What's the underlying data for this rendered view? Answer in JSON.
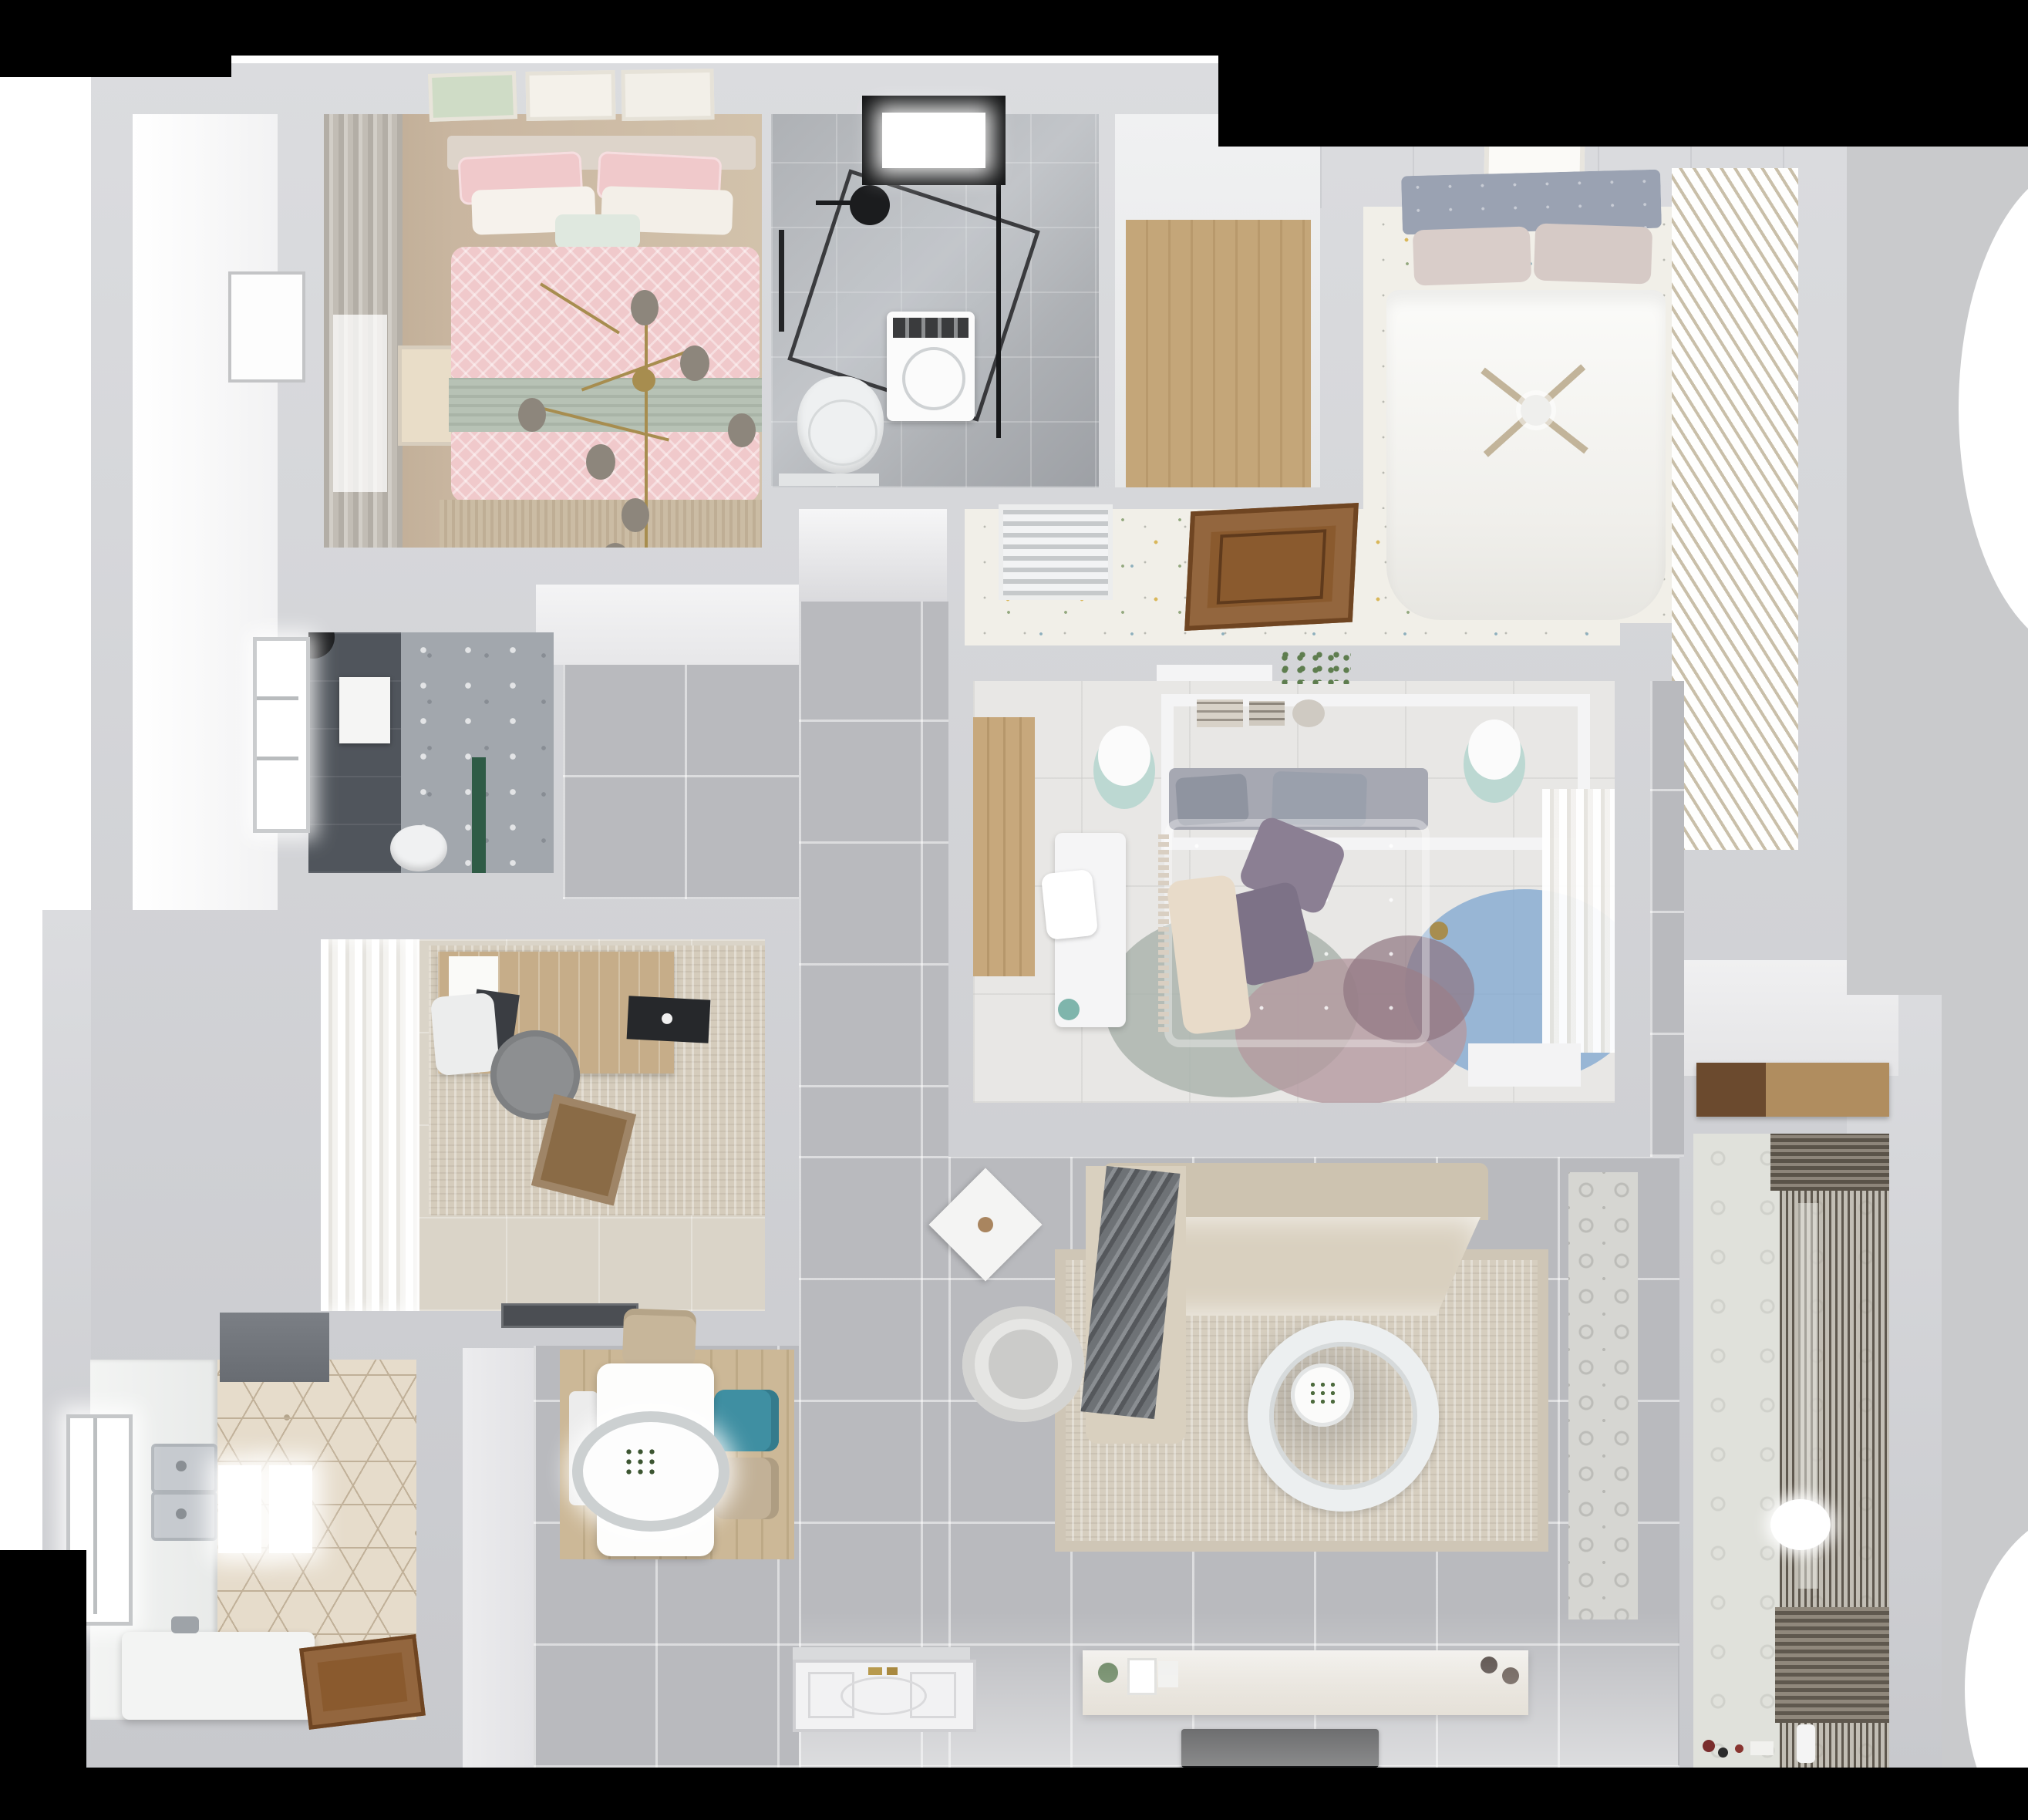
{
  "scene": {
    "type": "3d-floor-plan-render",
    "view": "top-down",
    "description": "Photorealistic bird's-eye render of a three-bedroom apartment interior"
  },
  "colors": {
    "black": "#000000",
    "wall": "#c8c9cd",
    "wallLight": "#dbdcdf",
    "tile": "#b9babe",
    "corridorGlow": "#efeff1",
    "marble": "#aeb1b5",
    "darkTile": "#50555c",
    "shadowRight": "#c9cacc",
    "woodCloset": "#c4a679",
    "br2Wood": "#c9b6a0",
    "pink": "#f0c9cb",
    "sage": "#b7c2b5",
    "gold": "#a78d4f",
    "smokeGlass": "#8d867c",
    "cream": "#dad4c8",
    "rugStudy": "#d5ccbc",
    "deskWood": "#c6ad89",
    "hexFloor": "#e6dccb",
    "hexLine": "#c0b098",
    "fridge": "#686c72",
    "steel": "#c6cacf",
    "island": "#f3f4f3",
    "doorBrown": "#8a5a2e",
    "diningWood": "#ccb897",
    "teal": "#3f8fa2",
    "chairBeige": "#c7b69a",
    "sofa": "#cdc3b0",
    "sofaSeat": "#d9d0bf",
    "blanket": "#6e7276",
    "rugLiving": "#d6cebf",
    "consoleTop": "#f2f0ec",
    "tvBlack": "#141517",
    "balconyFloor": "#e0e1db",
    "shelfDark": "#6b4a2e",
    "shelfLight": "#b08d5f",
    "speckleBase": "#f1efe8",
    "speckDotY": "#d9b75a",
    "speckDotB": "#8fb0bd",
    "speckDotG": "#93a87e",
    "wardrobe": "#e9e2d4",
    "wardrobeLine": "#c9bfa9",
    "headboardBlue": "#9aa2b2",
    "br3Floor": "#e8e7e5",
    "purple": "#8b7f93",
    "mauve": "#7d7287",
    "rugBlue": "#7ea6cf",
    "rugGreen": "#a8b2aa",
    "rugPink": "#b49aa0",
    "mint": "#bcd8d2",
    "entryTile": "#d6d6d2",
    "greenPlant": "#5e7d4f",
    "greenDark": "#2f5b46",
    "fringeRug": "#cbbca4"
  },
  "rooms": [
    {
      "id": "bedroom-2",
      "label": "Bedroom with pink bed (top-left)",
      "furniture": [
        "double-bed",
        "pink-patterned-duvet",
        "sage-blanket",
        "pillows",
        "gold-branch-chandelier",
        "gray-curtains",
        "three-wall-art-frames",
        "fringe-rug",
        "side-door"
      ]
    },
    {
      "id": "bathroom",
      "label": "Bathroom (top-middle)",
      "furniture": [
        "black-framed-skylight",
        "glass-shower-enclosure",
        "black-shower-fixture",
        "washing-machine",
        "wall-hung-toilet",
        "marble-tiling"
      ]
    },
    {
      "id": "walk-in-closet",
      "label": "Walk-in closet (top-middle-right)",
      "furniture": [
        "wood-plank-floor"
      ]
    },
    {
      "id": "bedroom-1",
      "label": "Main bedroom with white bed (top-right)",
      "furniture": [
        "double-bed",
        "blue-gray-tufted-headboard",
        "white-duvet",
        "ceiling-fan",
        "slatted-wardrobe",
        "wall-art",
        "speckled-floor"
      ]
    },
    {
      "id": "hallway",
      "label": "Hallway with speckled floor",
      "furniture": [
        "ac-vent-grille",
        "open-wood-door",
        "plant-on-ledge"
      ]
    },
    {
      "id": "shower-room",
      "label": "Dark shower room (middle-left)",
      "furniture": [
        "window",
        "black-shower-set",
        "toilet",
        "towel-box",
        "green-accent"
      ]
    },
    {
      "id": "study",
      "label": "Study (middle-left)",
      "furniture": [
        "wood-desk",
        "laptop",
        "tablet",
        "white-desk-chair",
        "gray-lounge-chair",
        "speckled-rug",
        "white-curtains",
        "cardboard-box",
        "dark-floor-mat"
      ]
    },
    {
      "id": "bedroom-3",
      "label": "Middle bedroom",
      "furniture": [
        "canopy-bed",
        "gray-headboard",
        "floral-duvet",
        "purple-pillows",
        "overlapping-circle-rug",
        "white-desk",
        "mint-stools",
        "sheer-curtains",
        "wood-slat-accent",
        "shelf-with-books"
      ]
    },
    {
      "id": "kitchen",
      "label": "Kitchen (bottom-left)",
      "furniture": [
        "dark-fridge",
        "double-stainless-sink",
        "white-counter",
        "white-island",
        "window",
        "hexagon-tile-floor",
        "open-wood-door",
        "ceiling-light-panels"
      ]
    },
    {
      "id": "dining",
      "label": "Dining area",
      "furniture": [
        "white-table",
        "oval-pendant-lamp-with-plant",
        "teal-chair",
        "beige-chairs",
        "white-bench",
        "wood-floor-panel"
      ]
    },
    {
      "id": "living-room",
      "label": "Living room",
      "furniture": [
        "l-shaped-sofa",
        "striped-blanket",
        "large-area-rug",
        "round-ring-coffee-table",
        "armchair",
        "diamond-side-table",
        "tv-console-with-decor",
        "flat-tv"
      ]
    },
    {
      "id": "entry",
      "label": "Entry",
      "furniture": [
        "paneled-front-door-with-gold-handle",
        "patterned-cement-tile-strip"
      ]
    },
    {
      "id": "balcony",
      "label": "Balcony / laundry (bottom-right)",
      "furniture": [
        "dark-vertical-blinds",
        "patterned-floor",
        "wood-storage-shelf",
        "floor-light-ellipse",
        "toys",
        "bottle"
      ]
    }
  ]
}
